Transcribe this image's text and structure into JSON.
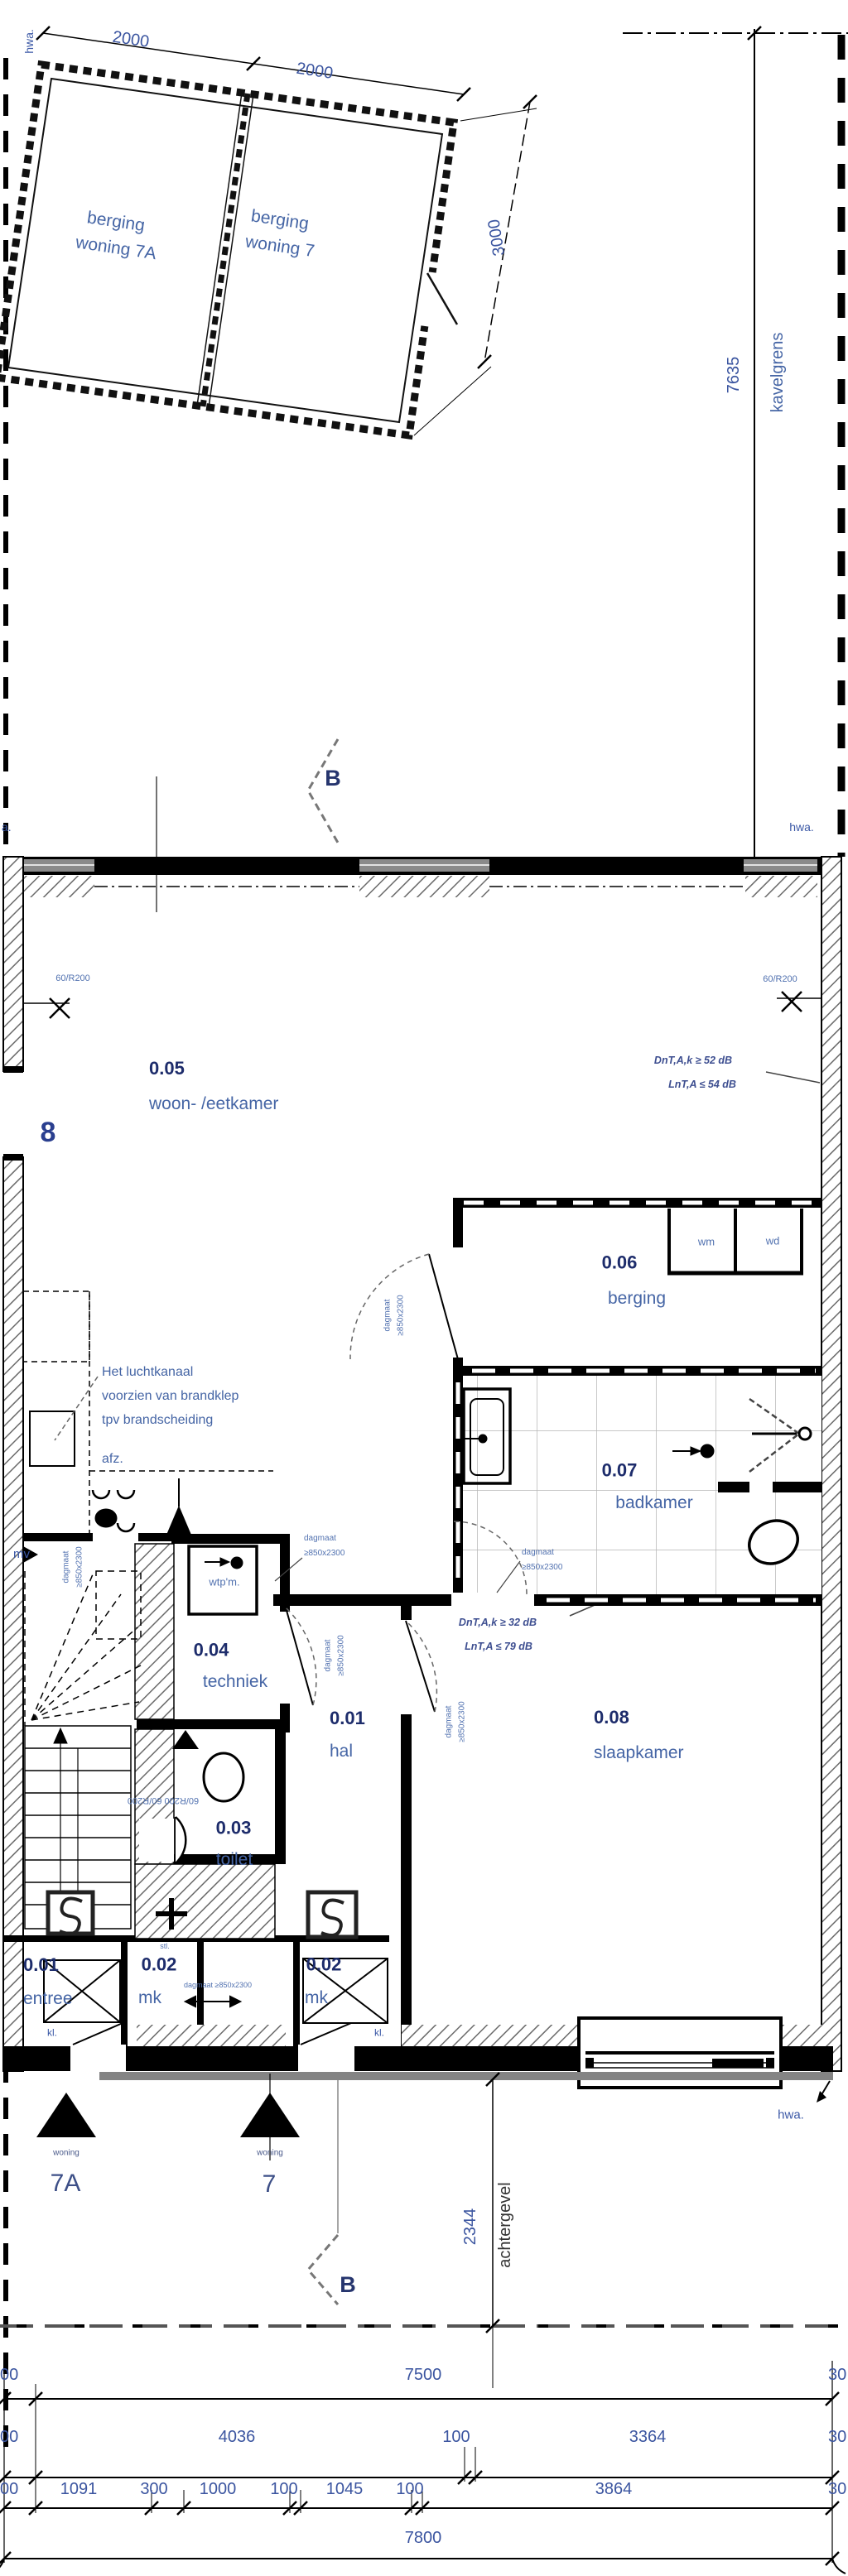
{
  "site": {
    "hwa_top": "hwa.",
    "hwa_left_cut": "a.",
    "hwa_right": "hwa.",
    "hwa_bottom": "hwa.",
    "kavelgrens": "kavelgrens",
    "kavel_dim": "7635",
    "rear_offset_dim": "2344",
    "achtergevel": "achtergevel"
  },
  "sheds": {
    "dim_a": "2000",
    "dim_b": "2000",
    "dim_c": "3000",
    "shed_a": [
      "berging",
      "woning 7A"
    ],
    "shed_b": [
      "berging",
      "woning 7"
    ]
  },
  "section": {
    "label": "B"
  },
  "grid": {
    "left_axis": "8"
  },
  "rooms": [
    {
      "no": "0.05",
      "name": "woon- /eetkamer"
    },
    {
      "no": "0.06",
      "name": "berging"
    },
    {
      "no": "0.07",
      "name": "badkamer"
    },
    {
      "no": "0.04",
      "name": "techniek"
    },
    {
      "no": "0.01",
      "name": "hal"
    },
    {
      "no": "0.08",
      "name": "slaapkamer"
    },
    {
      "no": "0.03",
      "name": "toilet"
    },
    {
      "no": "0.01",
      "name": "entree"
    },
    {
      "no": "0.02",
      "name": "mk"
    },
    {
      "no": "0.02",
      "name": "mk"
    }
  ],
  "appliances": {
    "wm": "wm",
    "wd": "wd",
    "wtpm": "wtp'm.",
    "afz": "afz.",
    "mv": "mv",
    "stl": "stl.",
    "kl": "kl."
  },
  "acoustic": {
    "line1a": "DnT,A,k ≥ 52 dB",
    "line1b": "LnT,A ≤ 54 dB",
    "line2a": "DnT,A,k ≥ 32 dB",
    "line2b": "LnT,A ≤ 79 dB"
  },
  "notes": {
    "duct1": "Het luchtkanaal",
    "duct2": "voorzien van brandklep",
    "duct3": "tpv brandscheiding"
  },
  "openings": {
    "r200": "60/R200",
    "r200_pair": "60/R200  60/R200",
    "dagmaat1": "dagmaat",
    "dagmaat2": "≥850x2300"
  },
  "entrances": {
    "woning": "woning",
    "unit_a": "7A",
    "unit_b": "7"
  },
  "dims": {
    "row1": [
      "00",
      "7500",
      "30"
    ],
    "row2": [
      "00",
      "4036",
      "100",
      "3364",
      "30"
    ],
    "row3": [
      "00",
      "1091",
      "300",
      "1000",
      "100",
      "1045",
      "100",
      "3864",
      "30"
    ],
    "row4": [
      "7800"
    ]
  }
}
